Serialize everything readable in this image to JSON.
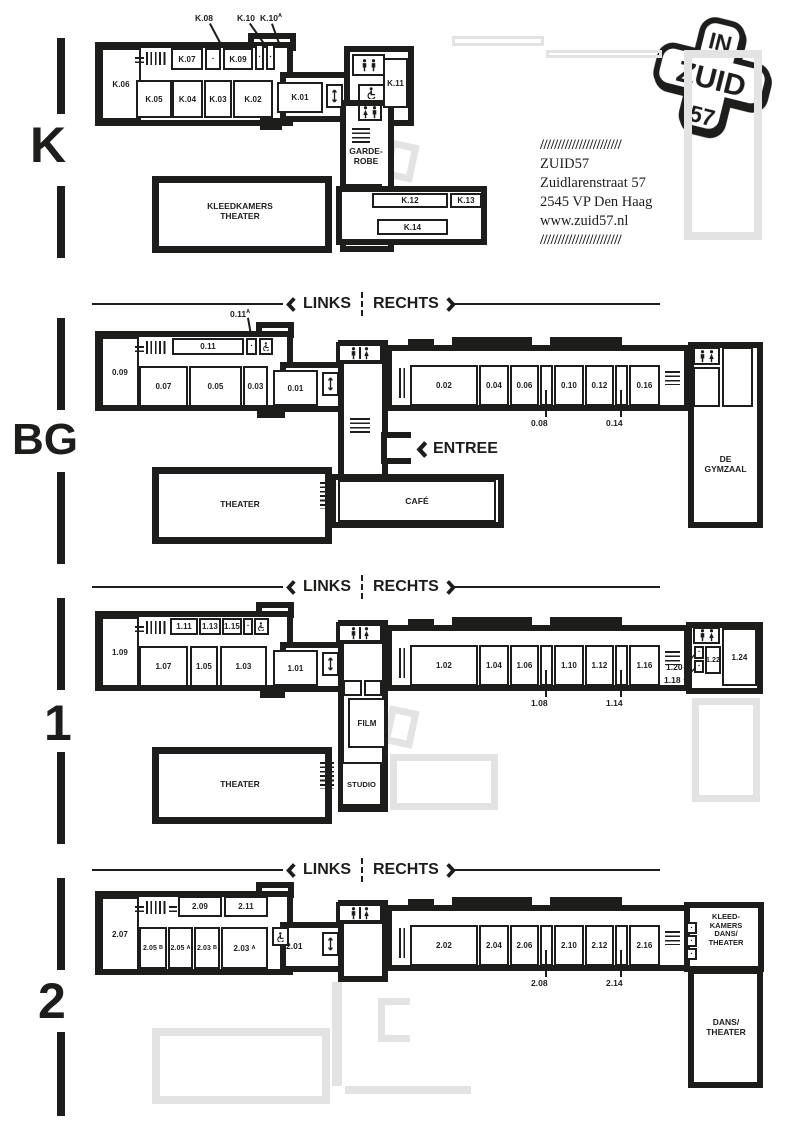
{
  "palette": {
    "ink": "#1d1d1b",
    "ghost": "#e3e3e3",
    "paper": "#ffffff"
  },
  "logo": {
    "top": "IN",
    "middle": "ZUID",
    "bottom": "57"
  },
  "address": {
    "slashes": "///////////////////////",
    "name": "ZUID57",
    "street": "Zuidlarenstraat 57",
    "city": "2545 VP Den Haag",
    "website": "www.zuid57.nl"
  },
  "direction": {
    "links": "LINKS",
    "rechts": "RECHTS"
  },
  "entree": "ENTREE",
  "icons": {
    "dot": "▪",
    "elevator": "up-down-arrow",
    "toilet": "person-figures",
    "accessible": "wheelchair",
    "stairs": "hatch-lines"
  },
  "floors": {
    "k": {
      "label": "K",
      "rooms": {
        "k06": "K.06",
        "k07": "K.07",
        "k09": "K.09",
        "k05": "K.05",
        "k04": "K.04",
        "k03": "K.03",
        "k02": "K.02",
        "k01": "K.01",
        "k11": "K.11",
        "k12": "K.12",
        "k13": "K.13",
        "k14": "K.14"
      },
      "callouts": {
        "k08": "K.08",
        "k10": "K.10",
        "k10a": {
          "base": "K.10",
          "suffix": "A"
        }
      },
      "garderobe": "GARDE-\nROBE",
      "kleedkamers": "KLEEDKAMERS\nTHEATER"
    },
    "bg": {
      "label": "BG",
      "rooms": {
        "r09": "0.09",
        "r11": "0.11",
        "r07": "0.07",
        "r05": "0.05",
        "r03": "0.03",
        "r01": "0.01",
        "r02": "0.02",
        "r04": "0.04",
        "r06": "0.06",
        "r10": "0.10",
        "r12": "0.12",
        "r16": "0.16"
      },
      "callouts": {
        "r11a": {
          "base": "0.11",
          "suffix": "A"
        },
        "r08": "0.08",
        "r14": "0.14"
      },
      "theater": "THEATER",
      "cafe": "CAFÉ",
      "gymzaal": "DE\nGYMZAAL"
    },
    "f1": {
      "label": "1",
      "rooms": {
        "r09": "1.09",
        "r11": "1.11",
        "r13": "1.13",
        "r15": "1.15",
        "r07": "1.07",
        "r05": "1.05",
        "r03": "1.03",
        "r01": "1.01",
        "r02": "1.02",
        "r04": "1.04",
        "r06": "1.06",
        "r10": "1.10",
        "r12": "1.12",
        "r16": "1.16",
        "r22": "1.22",
        "r24": "1.24"
      },
      "callouts": {
        "r08": "1.08",
        "r14": "1.14",
        "r18": "1.18",
        "r20": "1.20"
      },
      "film": "FILM",
      "studio": "STUDIO",
      "theater": "THEATER"
    },
    "f2": {
      "label": "2",
      "rooms": {
        "r07": "2.07",
        "r09": "2.09",
        "r11": "2.11",
        "r05b": {
          "base": "2.05",
          "suffix": "B"
        },
        "r05a": {
          "base": "2.05",
          "suffix": "A"
        },
        "r03b": {
          "base": "2.03",
          "suffix": "B"
        },
        "r03a": {
          "base": "2.03",
          "suffix": "A"
        },
        "r01": "2.01",
        "r02": "2.02",
        "r04": "2.04",
        "r06": "2.06",
        "r10": "2.10",
        "r12": "2.12",
        "r16": "2.16"
      },
      "callouts": {
        "r08": "2.08",
        "r14": "2.14"
      },
      "kleedkamers": "KLEED-\nKAMERS\nDANS/\nTHEATER",
      "dans": "DANS/\nTHEATER"
    }
  }
}
